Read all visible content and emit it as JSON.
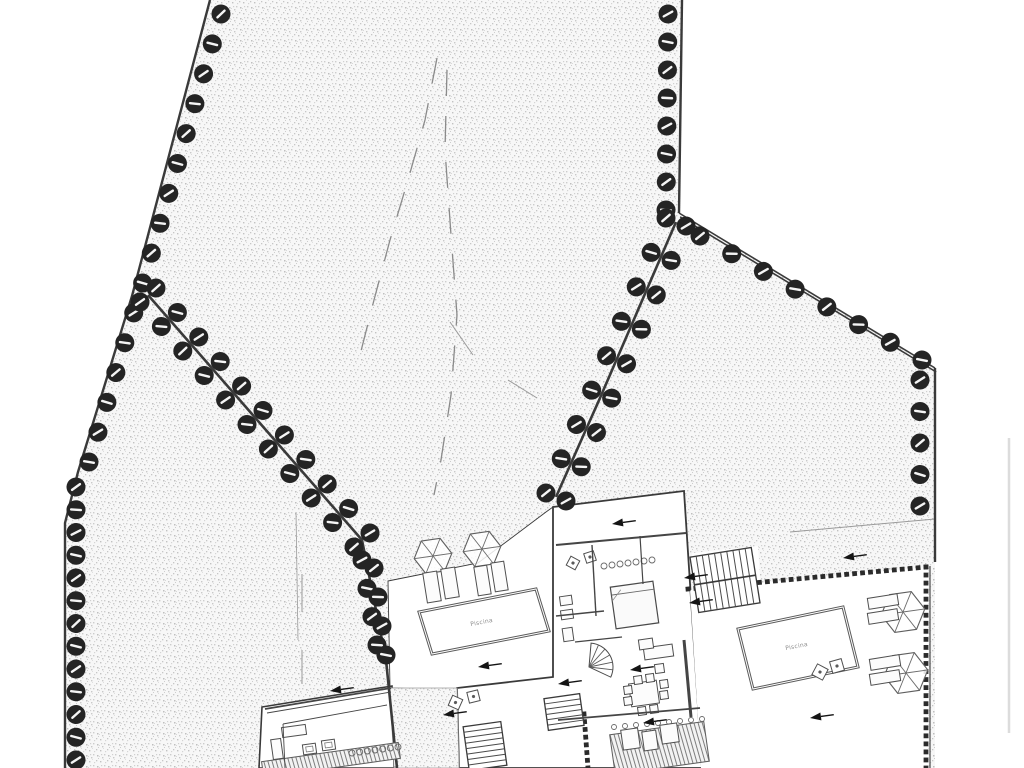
{
  "document": {
    "kind": "architectural-site-plan",
    "title": "Site plan with villas, pools and tree-lined boundaries",
    "labels": {
      "pool_left": "Piscina",
      "pool_right": "Piscina"
    },
    "colors": {
      "paper": "#ffffff",
      "ink": "#3a3a3a",
      "ink_light": "#8f8f8f",
      "tree": "#242424",
      "wall_dot": "#2b2b2b",
      "stipple_bg": "#f7f7f7",
      "dash": "#8a8a8a",
      "scan_artifact": "#dcdcdc"
    }
  },
  "plan": {
    "terrain_polygon": [
      [
        210,
        0
      ],
      [
        682,
        0
      ],
      [
        679,
        213
      ],
      [
        935,
        368
      ],
      [
        935,
        768
      ],
      [
        65,
        768
      ],
      [
        65,
        523
      ],
      [
        78,
        472
      ],
      [
        132,
        296
      ]
    ],
    "white_areas": [
      {
        "name": "left-terrace",
        "pts": [
          [
            388,
            581
          ],
          [
            478,
            563
          ],
          [
            546,
            512
          ],
          [
            553,
            507
          ],
          [
            556,
            690
          ],
          [
            458,
            690
          ],
          [
            390,
            688
          ]
        ],
        "stroke": 0.9
      },
      {
        "name": "middle-villa",
        "pts": [
          [
            553,
            507
          ],
          [
            684,
            491
          ],
          [
            702,
            768
          ],
          [
            459,
            768
          ],
          [
            457,
            688
          ],
          [
            553,
            677
          ]
        ],
        "stroke": 1.8
      },
      {
        "name": "left-villa",
        "pts": [
          [
            262,
            707
          ],
          [
            392,
            686
          ],
          [
            394,
            768
          ],
          [
            259,
            768
          ]
        ],
        "stroke": 1.6
      },
      {
        "name": "right-terrace",
        "pts": [
          [
            690,
            590
          ],
          [
            928,
            567
          ],
          [
            928,
            768
          ],
          [
            701,
            768
          ]
        ],
        "stroke": 0
      },
      {
        "name": "stair-pad",
        "pts": [
          [
            692,
            553
          ],
          [
            758,
            546
          ],
          [
            762,
            608
          ],
          [
            696,
            615
          ]
        ],
        "stroke": 0
      }
    ],
    "gravel_areas": [
      {
        "name": "gravel-path",
        "pts": [
          [
            390,
            688
          ],
          [
            457,
            688
          ],
          [
            459,
            768
          ],
          [
            394,
            768
          ]
        ]
      }
    ],
    "boundary_lines": [
      {
        "name": "boundary-left",
        "pts": [
          [
            210,
            0
          ],
          [
            132,
            296
          ],
          [
            78,
            472
          ],
          [
            65,
            523
          ],
          [
            65,
            768
          ]
        ],
        "w": 2.4
      },
      {
        "name": "boundary-top-right",
        "pts": [
          [
            682,
            0
          ],
          [
            679,
            213
          ]
        ],
        "w": 2.4
      },
      {
        "name": "boundary-right-diagonal",
        "pts": [
          [
            679,
            213
          ],
          [
            935,
            368
          ]
        ],
        "w": 1.6,
        "double": 4
      },
      {
        "name": "boundary-right-vertical",
        "pts": [
          [
            935,
            368
          ],
          [
            935,
            562
          ]
        ],
        "w": 2.4
      },
      {
        "name": "internal-wall-left",
        "pts": [
          [
            148,
            295
          ],
          [
            362,
            540
          ],
          [
            378,
            620
          ],
          [
            386,
            660
          ],
          [
            397,
            768
          ]
        ],
        "w": 2.6
      },
      {
        "name": "internal-wall-right",
        "pts": [
          [
            676,
            222
          ],
          [
            600,
            398
          ],
          [
            556,
            497
          ]
        ],
        "w": 2.6
      },
      {
        "name": "right-edge-line",
        "pts": [
          [
            930,
            566
          ],
          [
            930,
            768
          ]
        ],
        "w": 1.1
      }
    ],
    "tree_lines": [
      {
        "name": "trees-left-upper",
        "path": [
          [
            221,
            14
          ],
          [
            140,
            292
          ],
          [
            89,
            462
          ]
        ],
        "n": 16
      },
      {
        "name": "trees-left-lower",
        "path": [
          [
            76,
            487
          ],
          [
            76,
            760
          ]
        ],
        "n": 13
      },
      {
        "name": "trees-top-right",
        "path": [
          [
            668,
            14
          ],
          [
            666,
            210
          ]
        ],
        "n": 8
      },
      {
        "name": "trees-right-diagonal",
        "path": [
          [
            700,
            236
          ],
          [
            922,
            360
          ]
        ],
        "n": 8
      },
      {
        "name": "trees-right-vertical",
        "path": [
          [
            920,
            380
          ],
          [
            920,
            506
          ]
        ],
        "n": 5
      },
      {
        "name": "trees-internal-left-a",
        "path": [
          [
            156,
            288
          ],
          [
            370,
            533
          ]
        ],
        "n": 11
      },
      {
        "name": "trees-internal-left-b",
        "path": [
          [
            140,
            302
          ],
          [
            354,
            547
          ]
        ],
        "n": 11
      },
      {
        "name": "trees-internal-left-c1",
        "path": [
          [
            362,
            560
          ],
          [
            377,
            645
          ]
        ],
        "n": 4
      },
      {
        "name": "trees-internal-left-c2",
        "path": [
          [
            374,
            568
          ],
          [
            386,
            655
          ]
        ],
        "n": 4
      },
      {
        "name": "trees-internal-right-a",
        "path": [
          [
            686,
            226
          ],
          [
            610,
            402
          ],
          [
            566,
            501
          ]
        ],
        "n": 9
      },
      {
        "name": "trees-internal-right-b",
        "path": [
          [
            666,
            218
          ],
          [
            590,
            394
          ],
          [
            546,
            493
          ]
        ],
        "n": 9
      }
    ],
    "tree_radius": 9.5,
    "dashed_paths": [
      {
        "name": "path-centerline-west",
        "pts": [
          [
            437,
            58
          ],
          [
            425,
            120
          ],
          [
            408,
            180
          ],
          [
            390,
            240
          ],
          [
            374,
            300
          ],
          [
            360,
            355
          ]
        ]
      },
      {
        "name": "path-centerline-east",
        "pts": [
          [
            447,
            70
          ],
          [
            445,
            150
          ],
          [
            451,
            235
          ],
          [
            457,
            315
          ],
          [
            451,
            395
          ],
          [
            441,
            460
          ],
          [
            434,
            495
          ]
        ]
      }
    ],
    "stray_segments": [
      {
        "pts": [
          [
            450,
            322
          ],
          [
            473,
            355
          ]
        ],
        "w": 1
      },
      {
        "pts": [
          [
            508,
            380
          ],
          [
            537,
            398
          ]
        ],
        "w": 1
      },
      {
        "pts": [
          [
            302,
            574
          ],
          [
            302,
            612
          ]
        ],
        "w": 1
      },
      {
        "pts": [
          [
            302,
            650
          ],
          [
            302,
            684
          ]
        ],
        "w": 1
      },
      {
        "pts": [
          [
            296,
            512
          ],
          [
            298,
            640
          ]
        ],
        "w": 0.8
      },
      {
        "pts": [
          [
            790,
            532
          ],
          [
            935,
            519
          ]
        ],
        "w": 1
      },
      {
        "pts": [
          [
            1009,
            438
          ],
          [
            1009,
            733
          ]
        ],
        "w": 2.5,
        "color": "#dcdcdc"
      }
    ],
    "dotted_walls": [
      {
        "name": "terrace-wall-top",
        "pts": [
          [
            688,
            589
          ],
          [
            926,
            567
          ]
        ]
      },
      {
        "name": "terrace-wall-right",
        "pts": [
          [
            926,
            567
          ],
          [
            926,
            768
          ]
        ]
      },
      {
        "name": "villa-wall-lower",
        "pts": [
          [
            584,
            714
          ],
          [
            588,
            768
          ]
        ]
      }
    ],
    "pools": [
      {
        "name": "pool-left",
        "pts": [
          [
            419,
            612
          ],
          [
            536,
            589
          ],
          [
            549,
            631
          ],
          [
            432,
            654
          ]
        ],
        "label_key": "pool_left",
        "lx": 482,
        "ly": 624,
        "lrot": -11
      },
      {
        "name": "pool-right",
        "pts": [
          [
            738,
            629
          ],
          [
            843,
            607
          ],
          [
            858,
            667
          ],
          [
            753,
            689
          ]
        ],
        "label_key": "pool_right",
        "lx": 797,
        "ly": 648,
        "lrot": -11
      }
    ],
    "umbrellas": [
      {
        "cx": 433,
        "cy": 556,
        "r": 19
      },
      {
        "cx": 482,
        "cy": 549,
        "r": 19
      },
      {
        "cx": 903,
        "cy": 612,
        "r": 22
      },
      {
        "cx": 906,
        "cy": 673,
        "r": 22
      }
    ],
    "stairs": [
      {
        "x": 694,
        "y": 552,
        "w": 62,
        "h": 56,
        "rot": -9,
        "n": 10,
        "divider": true
      },
      {
        "x": 466,
        "y": 724,
        "w": 38,
        "h": 44,
        "rot": -8,
        "n": 8,
        "horizontal": true
      },
      {
        "x": 546,
        "y": 696,
        "w": 36,
        "h": 32,
        "rot": -8,
        "n": 6,
        "horizontal": true
      }
    ],
    "decks": [
      {
        "x": 612,
        "y": 728,
        "w": 95,
        "h": 40,
        "rot": -8
      },
      {
        "x": 262,
        "y": 752,
        "w": 138,
        "h": 16,
        "rot": -8
      }
    ],
    "scallop_rows": [
      {
        "a": [
          604,
          566
        ],
        "b": [
          652,
          560
        ],
        "n": 7,
        "r": 3
      },
      {
        "a": [
          352,
          753
        ],
        "b": [
          398,
          747
        ],
        "n": 7,
        "r": 3
      },
      {
        "a": [
          614,
          727
        ],
        "b": [
          702,
          719
        ],
        "n": 9,
        "r": 2.5
      }
    ],
    "bed": {
      "x": 613,
      "y": 584,
      "w": 43,
      "h": 42,
      "rot": -8
    },
    "furniture_rects": [
      {
        "x": 644,
        "y": 646,
        "w": 29,
        "h": 12,
        "rot": -8
      },
      {
        "x": 639,
        "y": 639,
        "w": 14,
        "h": 10,
        "rot": -8
      },
      {
        "x": 655,
        "y": 664,
        "w": 9,
        "h": 9,
        "rot": -8
      },
      {
        "x": 630,
        "y": 682,
        "w": 28,
        "h": 23,
        "rot": -8
      },
      {
        "x": 624,
        "y": 686,
        "w": 8,
        "h": 8,
        "rot": -8
      },
      {
        "x": 624,
        "y": 697,
        "w": 8,
        "h": 8,
        "rot": -8
      },
      {
        "x": 660,
        "y": 680,
        "w": 8,
        "h": 8,
        "rot": -8
      },
      {
        "x": 660,
        "y": 691,
        "w": 8,
        "h": 8,
        "rot": -8
      },
      {
        "x": 634,
        "y": 676,
        "w": 8,
        "h": 8,
        "rot": -8
      },
      {
        "x": 646,
        "y": 674,
        "w": 8,
        "h": 8,
        "rot": -8
      },
      {
        "x": 638,
        "y": 707,
        "w": 8,
        "h": 8,
        "rot": -8
      },
      {
        "x": 650,
        "y": 705,
        "w": 8,
        "h": 8,
        "rot": -8
      },
      {
        "x": 560,
        "y": 596,
        "w": 12,
        "h": 9,
        "rot": -8
      },
      {
        "x": 561,
        "y": 610,
        "w": 12,
        "h": 9,
        "rot": -8
      },
      {
        "x": 563,
        "y": 628,
        "w": 10,
        "h": 13,
        "rot": -8
      },
      {
        "x": 622,
        "y": 729,
        "w": 17,
        "h": 20,
        "rot": -8
      },
      {
        "x": 643,
        "y": 731,
        "w": 14,
        "h": 19,
        "rot": -8
      },
      {
        "x": 661,
        "y": 724,
        "w": 17,
        "h": 19,
        "rot": -8
      },
      {
        "x": 282,
        "y": 726,
        "w": 24,
        "h": 10,
        "rot": -8
      },
      {
        "x": 272,
        "y": 739,
        "w": 10,
        "h": 20,
        "rot": -8
      },
      {
        "x": 425,
        "y": 572,
        "w": 14,
        "h": 30,
        "rot": -9
      },
      {
        "x": 443,
        "y": 568,
        "w": 14,
        "h": 30,
        "rot": -9
      },
      {
        "x": 476,
        "y": 566,
        "w": 13,
        "h": 29,
        "rot": -9
      },
      {
        "x": 493,
        "y": 562,
        "w": 13,
        "h": 29,
        "rot": -9
      },
      {
        "x": 868,
        "y": 596,
        "w": 30,
        "h": 11,
        "rot": -9
      },
      {
        "x": 868,
        "y": 611,
        "w": 30,
        "h": 11,
        "rot": -9
      },
      {
        "x": 870,
        "y": 657,
        "w": 30,
        "h": 11,
        "rot": -9
      },
      {
        "x": 870,
        "y": 672,
        "w": 30,
        "h": 11,
        "rot": -9
      }
    ],
    "inner_tables": [
      {
        "x": 303,
        "y": 744,
        "w": 13,
        "h": 10,
        "rot": -8
      },
      {
        "x": 322,
        "y": 740,
        "w": 13,
        "h": 10,
        "rot": -8
      }
    ],
    "tilted_chairs": [
      {
        "x": 568,
        "y": 558,
        "s": 10,
        "rot": 28
      },
      {
        "x": 585,
        "y": 552,
        "s": 10,
        "rot": -18
      },
      {
        "x": 450,
        "y": 697,
        "s": 11,
        "rot": 24
      },
      {
        "x": 468,
        "y": 691,
        "s": 11,
        "rot": -14
      },
      {
        "x": 814,
        "y": 666,
        "s": 12,
        "rot": 28
      },
      {
        "x": 831,
        "y": 660,
        "s": 12,
        "rot": -16
      }
    ],
    "inner_walls": [
      {
        "pts": [
          [
            556,
            545
          ],
          [
            686,
            533
          ]
        ],
        "w": 2
      },
      {
        "pts": [
          [
            592,
            545
          ],
          [
            596,
            616
          ]
        ],
        "w": 1.4
      },
      {
        "pts": [
          [
            556,
            616
          ],
          [
            604,
            611
          ]
        ],
        "w": 1.4
      },
      {
        "pts": [
          [
            640,
            536
          ],
          [
            643,
            584
          ]
        ],
        "w": 1.2
      },
      {
        "pts": [
          [
            684,
            640
          ],
          [
            691,
            717
          ]
        ],
        "w": 3
      },
      {
        "pts": [
          [
            575,
            642
          ],
          [
            622,
            637
          ]
        ],
        "w": 1.2
      },
      {
        "pts": [
          [
            558,
            720
          ],
          [
            700,
            708
          ]
        ],
        "w": 1.8
      },
      {
        "pts": [
          [
            265,
            709
          ],
          [
            391,
            688
          ]
        ],
        "w": 1.8
      },
      {
        "pts": [
          [
            267,
            713
          ],
          [
            391,
            692
          ]
        ],
        "w": 0.9
      },
      {
        "pts": [
          [
            283,
            724
          ],
          [
            387,
            705
          ]
        ],
        "w": 0.9
      },
      {
        "pts": [
          [
            283,
            724
          ],
          [
            285,
            768
          ]
        ],
        "w": 0.9
      }
    ],
    "spiral_stair": {
      "cx": 589,
      "cy": 667,
      "r": 24,
      "a0": -85,
      "a1": 25,
      "n": 6
    },
    "arrows": [
      {
        "x": 612,
        "y": 524
      },
      {
        "x": 684,
        "y": 578
      },
      {
        "x": 689,
        "y": 603
      },
      {
        "x": 843,
        "y": 558
      },
      {
        "x": 810,
        "y": 718
      },
      {
        "x": 478,
        "y": 667
      },
      {
        "x": 443,
        "y": 715
      },
      {
        "x": 330,
        "y": 691
      },
      {
        "x": 558,
        "y": 684
      },
      {
        "x": 630,
        "y": 670
      },
      {
        "x": 643,
        "y": 723
      }
    ],
    "arrow_rot": -8
  }
}
